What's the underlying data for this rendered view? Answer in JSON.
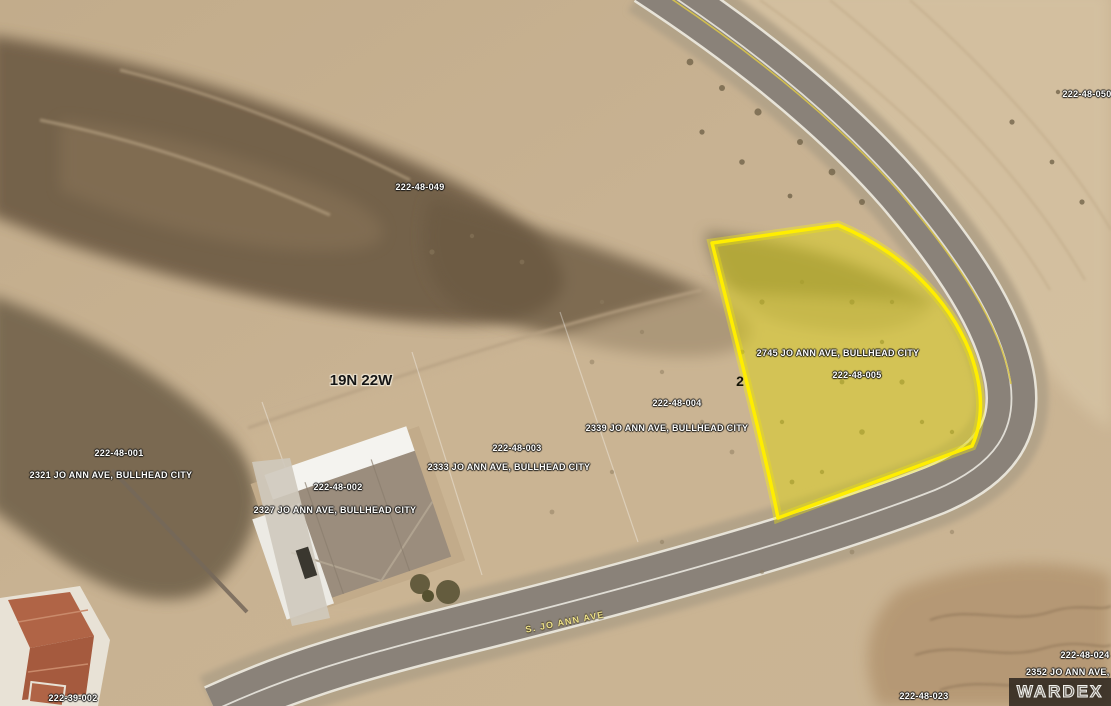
{
  "map": {
    "township_label": "19N 22W",
    "street_label": "S. JO ANN AVE",
    "watermark": "WARDEX",
    "highlighted_parcel": {
      "lot_number": "2",
      "address": "2745 JO ANN AVE, BULLHEAD CITY",
      "apn": "222-48-005",
      "highlight_fill": "#ded408",
      "highlight_stroke": "#ffee00"
    },
    "parcels": [
      {
        "apn": "222-48-049",
        "address": ""
      },
      {
        "apn": "222-48-050",
        "address": ""
      },
      {
        "apn": "222-48-001",
        "address": "2321 JO ANN AVE, BULLHEAD CITY"
      },
      {
        "apn": "222-48-002",
        "address": "2327 JO ANN AVE, BULLHEAD CITY"
      },
      {
        "apn": "222-48-003",
        "address": "2333 JO ANN AVE, BULLHEAD CITY"
      },
      {
        "apn": "222-48-004",
        "address": "2339 JO ANN AVE, BULLHEAD CITY"
      },
      {
        "apn": "222-48-024",
        "address": "2352 JO ANN AVE, BULLH"
      },
      {
        "apn": "222-48-023",
        "address": ""
      },
      {
        "apn": "222-39-002",
        "address": ""
      }
    ],
    "colors": {
      "desert": "#c6b090",
      "rocky_hillside": "#6e5c45",
      "asphalt": "#8a8279",
      "road_centerline_white": "#e9e7df",
      "road_centerline_yellow": "#d8c44a"
    }
  }
}
